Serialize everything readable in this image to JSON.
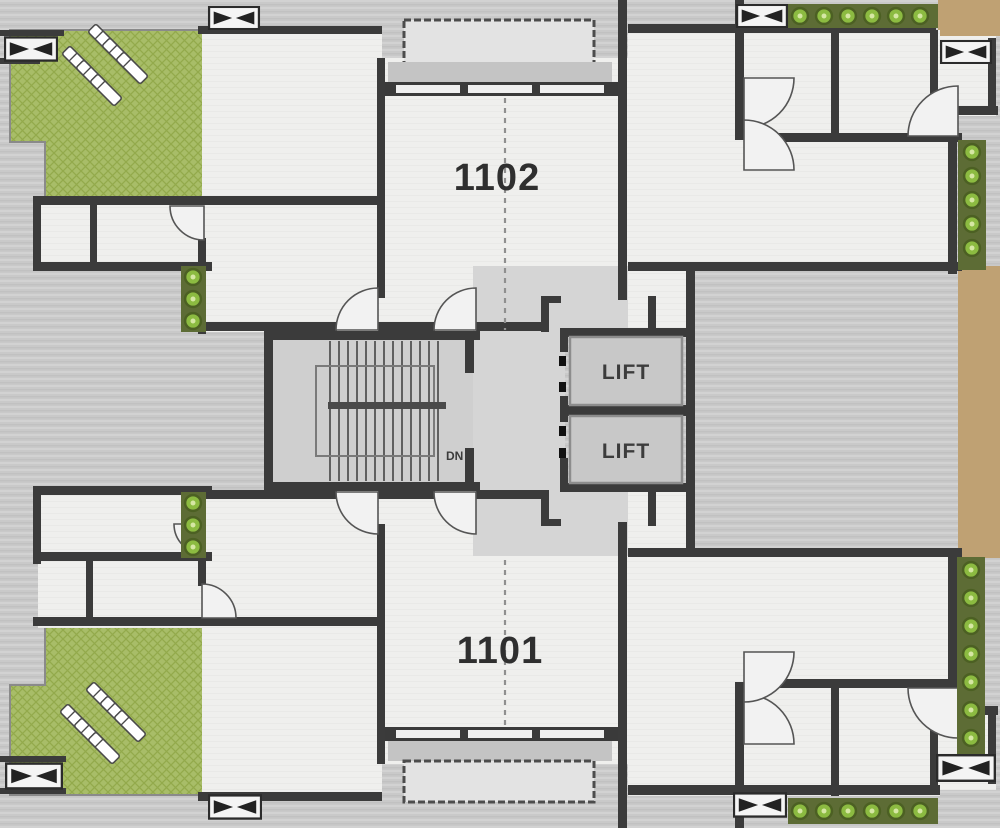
{
  "plan": {
    "title": "apartment-floor-plan",
    "units": [
      {
        "id": "unit-1102",
        "label": "1102"
      },
      {
        "id": "unit-1101",
        "label": "1101"
      }
    ],
    "lifts": [
      {
        "id": "lift-1",
        "label": "LIFT"
      },
      {
        "id": "lift-2",
        "label": "LIFT"
      }
    ],
    "stairs": {
      "down_label": "DN"
    },
    "features": {
      "terraces": [
        "terrace-top-left",
        "terrace-bottom-left"
      ],
      "balconies": [
        "balcony-1102-top",
        "balcony-1101-bottom"
      ],
      "planters": [
        "planter-top",
        "planter-right-upper",
        "planter-right-lower",
        "planter-bottom",
        "planter-inner-upper",
        "planter-inner-lower"
      ],
      "icons": [
        "plant-icon",
        "sun-lounger-icon",
        "window-bowtie-icon",
        "door-swing-icon"
      ]
    },
    "palette": {
      "background": "#c9c9c9",
      "room": "#efefed",
      "corridor": "#d5d5d5",
      "wall": "#3b3b3b",
      "terrace_green": "#a8bd68",
      "plant_green": "#8cbb41",
      "tan": "#bfa173",
      "lift_cab": "#c8c8c8",
      "label_text": "#2f2f2f"
    }
  }
}
